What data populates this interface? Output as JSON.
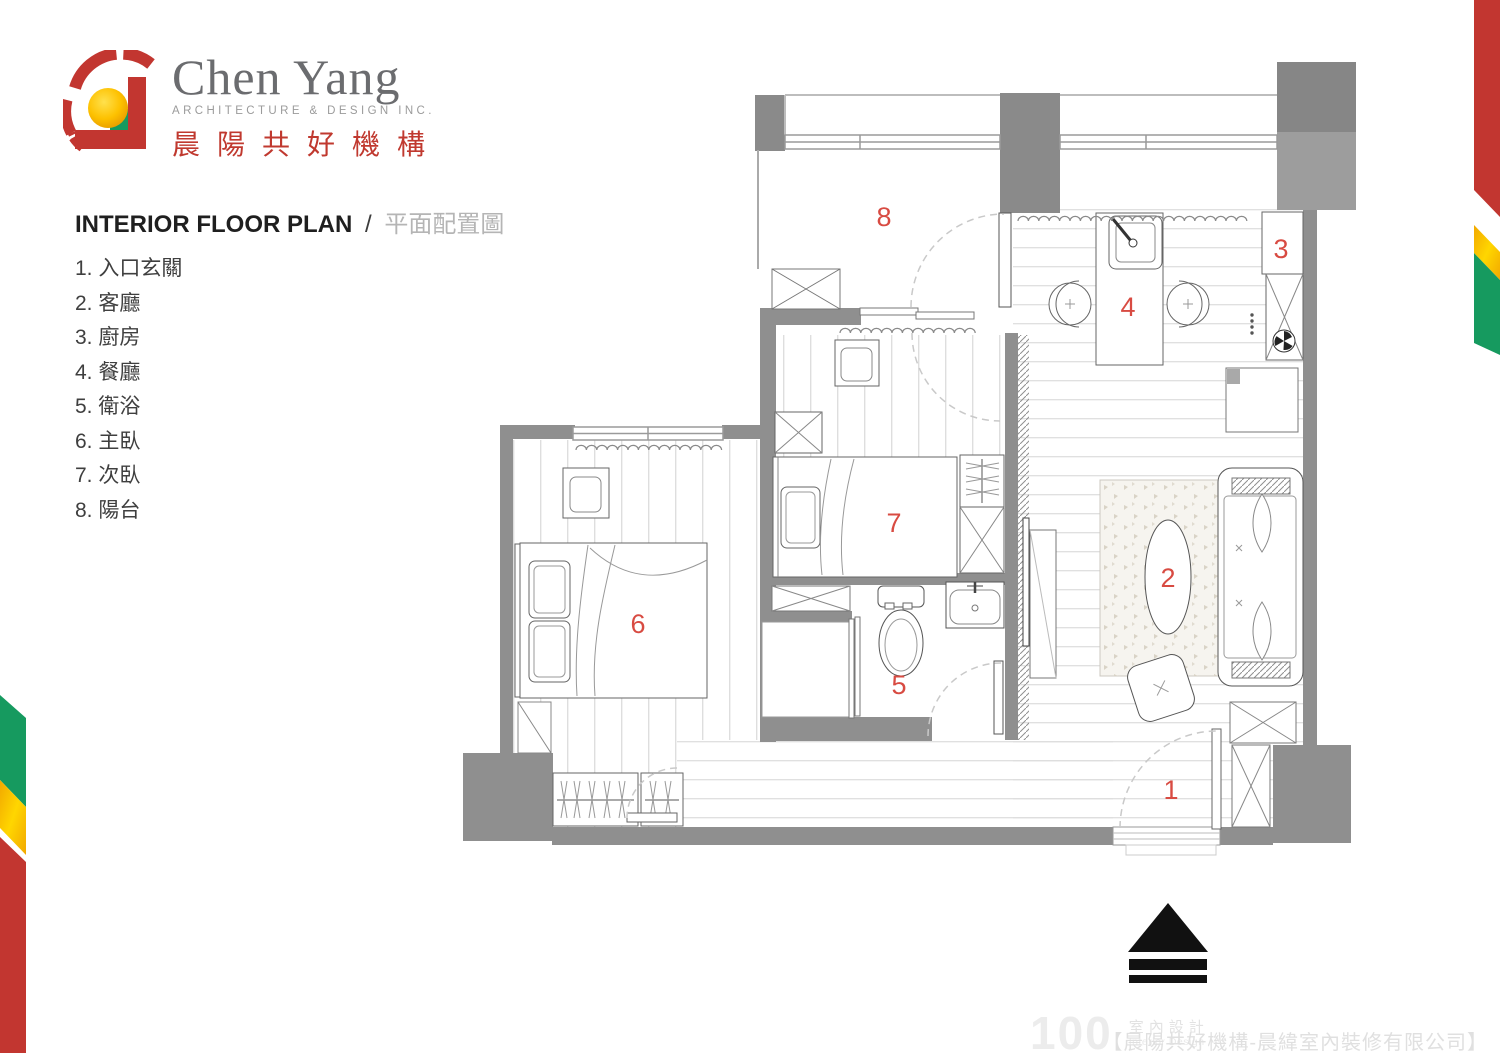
{
  "logo": {
    "name_en": "Chen Yang",
    "tagline": "ARCHITECTURE  &  DESIGN  INC.",
    "name_zh": "晨陽共好機構"
  },
  "heading": {
    "title_en": "INTERIOR FLOOR PLAN",
    "separator": "/",
    "title_zh": "平面配置圖"
  },
  "legend": {
    "items": [
      "1. 入口玄關",
      "2. 客廳",
      "3. 廚房",
      "4. 餐廳",
      "5. 衛浴",
      "6. 主臥",
      "7. 次臥",
      "8. 陽台"
    ]
  },
  "rooms": [
    {
      "no": "1",
      "name": "入口玄關"
    },
    {
      "no": "2",
      "name": "客廳"
    },
    {
      "no": "3",
      "name": "廚房"
    },
    {
      "no": "4",
      "name": "餐廳"
    },
    {
      "no": "5",
      "name": "衛浴"
    },
    {
      "no": "6",
      "name": "主臥"
    },
    {
      "no": "7",
      "name": "次臥"
    },
    {
      "no": "8",
      "name": "陽台"
    }
  ],
  "plan": {
    "labels": {
      "r1": "1",
      "r2": "2",
      "r3": "3",
      "r4": "4",
      "r5": "5",
      "r6": "6",
      "r7": "7",
      "r8": "8"
    }
  },
  "footer": {
    "brand_number": "100",
    "brand_zh": "室內設計",
    "brand_en": "Interior Design",
    "credit": "【晨陽共好機構-晨緯室內裝修有限公司】"
  },
  "colors": {
    "accent_red": "#c23630",
    "room_label_red": "#d84b42",
    "wall_gray": "#8f8f8f",
    "ribbon_green": "#169a5f",
    "ribbon_yellow": "#ffd200",
    "ribbon_red": "#c23630",
    "logo_gray": "#6b6c6f"
  }
}
